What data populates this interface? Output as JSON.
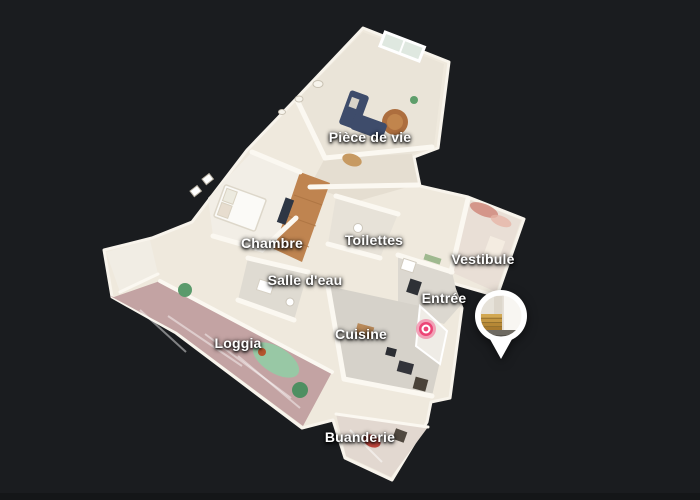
{
  "scene": {
    "name": "3d-dollhouse-view",
    "description": "3D dollhouse cutaway view of an apartment floor plan on dark background",
    "background_color": "#1a1c1f"
  },
  "room_labels": [
    {
      "text": "Pièce de vie",
      "x": 370,
      "y": 137
    },
    {
      "text": "Chambre",
      "x": 272,
      "y": 243
    },
    {
      "text": "Toilettes",
      "x": 374,
      "y": 240
    },
    {
      "text": "Vestibule",
      "x": 483,
      "y": 259
    },
    {
      "text": "Salle d'eau",
      "x": 305,
      "y": 280
    },
    {
      "text": "Entrée",
      "x": 444,
      "y": 298
    },
    {
      "text": "Cuisine",
      "x": 361,
      "y": 334
    },
    {
      "text": "Loggia",
      "x": 238,
      "y": 343
    },
    {
      "text": "Buanderie",
      "x": 360,
      "y": 437
    }
  ],
  "markers": {
    "position_marker": {
      "x": 426,
      "y": 329,
      "color": "#ec4576",
      "halo_color": "#f287a6",
      "inner_ring_color": "#ffffff"
    },
    "photo_pin": {
      "x": 501,
      "y": 316,
      "radius": 26,
      "tail_tip_y": 359,
      "ring_color": "#ffffff",
      "photo_subject": "staircase-preview"
    }
  },
  "palette": {
    "walls": "#f7f3ea",
    "floor_cream": "#eae4d8",
    "floor_wood": "#bf8450",
    "floor_loggia": "#c3a3a3",
    "sofa_navy": "#3e4c6b",
    "rug_brown": "#ad6e3e",
    "rug_green": "#90cfa6",
    "label_text": "#ffffff"
  }
}
